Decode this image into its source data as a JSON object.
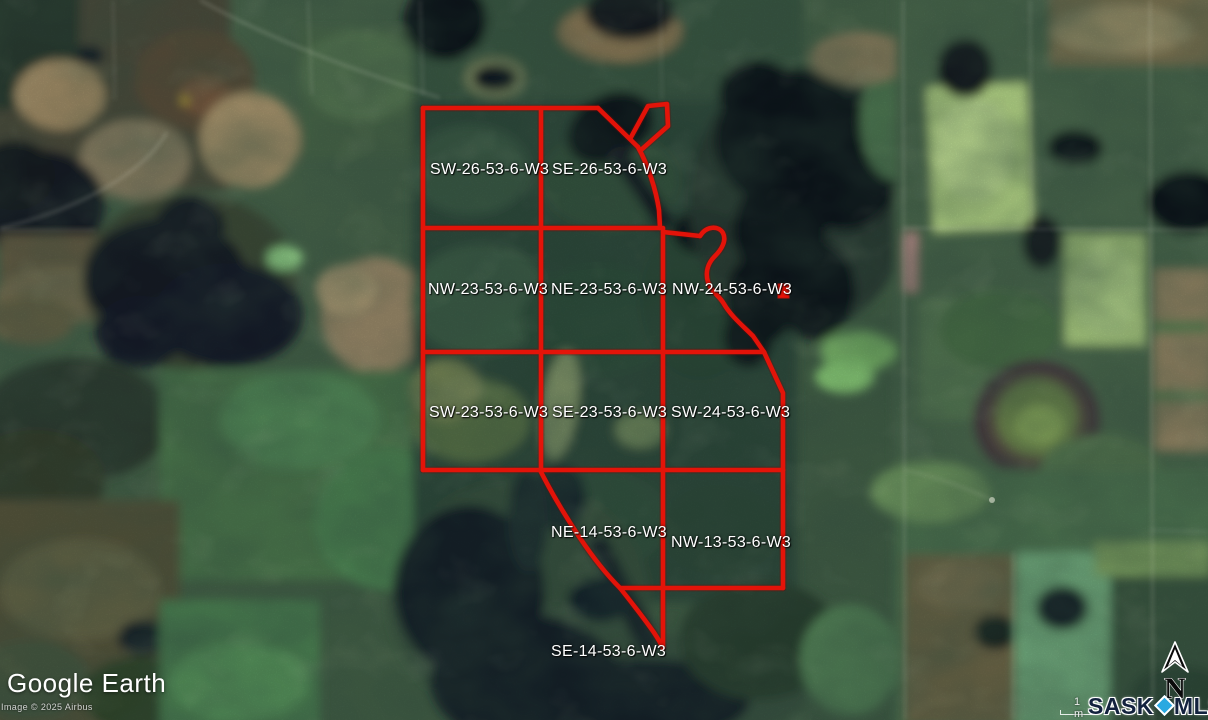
{
  "app": {
    "name": "Google Earth"
  },
  "map": {
    "type": "satellite-imagery",
    "attribution": {
      "logo": "Google Earth",
      "copyright": "Image © 2025 Airbus"
    },
    "scale_label": "1 m",
    "north_label": "N",
    "watermark": {
      "brand_left": "SASK",
      "brand_right": "MLS",
      "registered_mark": "®"
    },
    "colors": {
      "parcel_outline": "#EA1309",
      "parcel_label": "#FFFFFF",
      "water": "#10161E",
      "brand_navy": "#13223E",
      "brand_blue": "#2AA9E1"
    }
  },
  "parcels": [
    {
      "label": "SW-26-53-6-W3"
    },
    {
      "label": "SE-26-53-6-W3"
    },
    {
      "label": "NW-23-53-6-W3"
    },
    {
      "label": "NE-23-53-6-W3"
    },
    {
      "label": "NW-24-53-6-W3"
    },
    {
      "label": "SW-23-53-6-W3"
    },
    {
      "label": "SE-23-53-6-W3"
    },
    {
      "label": "SW-24-53-6-W3"
    },
    {
      "label": "NE-14-53-6-W3"
    },
    {
      "label": "NW-13-53-6-W3"
    },
    {
      "label": "SE-14-53-6-W3"
    }
  ]
}
